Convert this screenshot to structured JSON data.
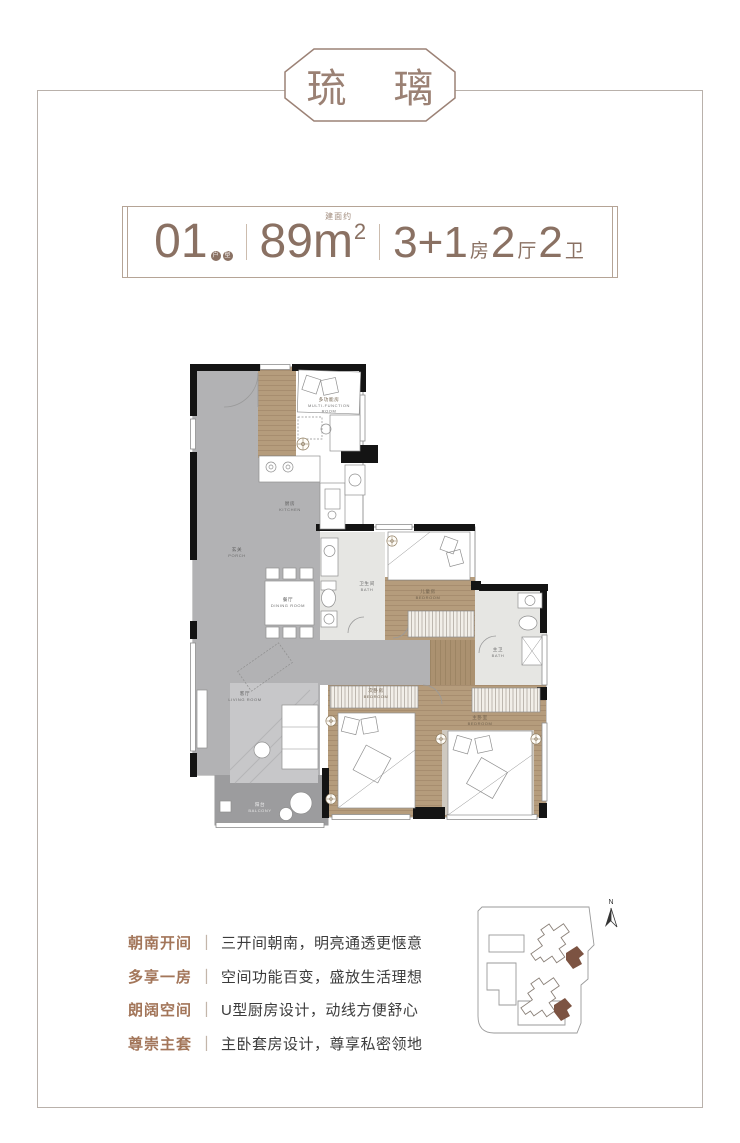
{
  "title": {
    "text": "琉 璃",
    "color": "#9b8174"
  },
  "unit_info": {
    "accent_color": "#8a7163",
    "number": "01",
    "badge_chars": [
      "户",
      "型"
    ],
    "area_note": "建面约",
    "area_number": "89m",
    "area_sup": "2",
    "layout": [
      {
        "num": "3+1",
        "label": "房"
      },
      {
        "num": "2",
        "label": "厅"
      },
      {
        "num": "2",
        "label": "卫"
      }
    ]
  },
  "floorplan": {
    "rooms": [
      {
        "id": "porch",
        "zh": "玄关",
        "en": "PORCH"
      },
      {
        "id": "mfr",
        "zh": "多功能房",
        "en1": "MULTI-FUNCTION",
        "en2": "ROOM"
      },
      {
        "id": "kitchen",
        "zh": "厨房",
        "en": "KITCHEN"
      },
      {
        "id": "dining",
        "zh": "餐厅",
        "en": "DINING ROOM"
      },
      {
        "id": "bath1",
        "zh": "卫生间",
        "en": "BATH"
      },
      {
        "id": "kidroom",
        "zh": "儿童房",
        "en": "BEDROOM"
      },
      {
        "id": "bath2",
        "zh": "主卫",
        "en": "BATH"
      },
      {
        "id": "living",
        "zh": "客厅",
        "en": "LIVING ROOM"
      },
      {
        "id": "balcony",
        "zh": "阳台",
        "en": "BALCONY"
      },
      {
        "id": "bedroom2",
        "zh": "次卧房",
        "en": "BEDROOM"
      },
      {
        "id": "master",
        "zh": "主卧室",
        "en": "BEDROOM"
      }
    ]
  },
  "features": {
    "separator": "丨",
    "items": [
      {
        "title": "朝南开间",
        "desc": "三开间朝南，明亮通透更惬意"
      },
      {
        "title": "多享一房",
        "desc": "空间功能百变，盛放生活理想"
      },
      {
        "title": "朗阔空间",
        "desc": "U型厨房设计，动线方便舒心"
      },
      {
        "title": "尊崇主套",
        "desc": "主卧套房设计，尊享私密领地"
      }
    ]
  },
  "siteplan": {
    "compass": "N",
    "highlight_color": "#7c5342"
  }
}
